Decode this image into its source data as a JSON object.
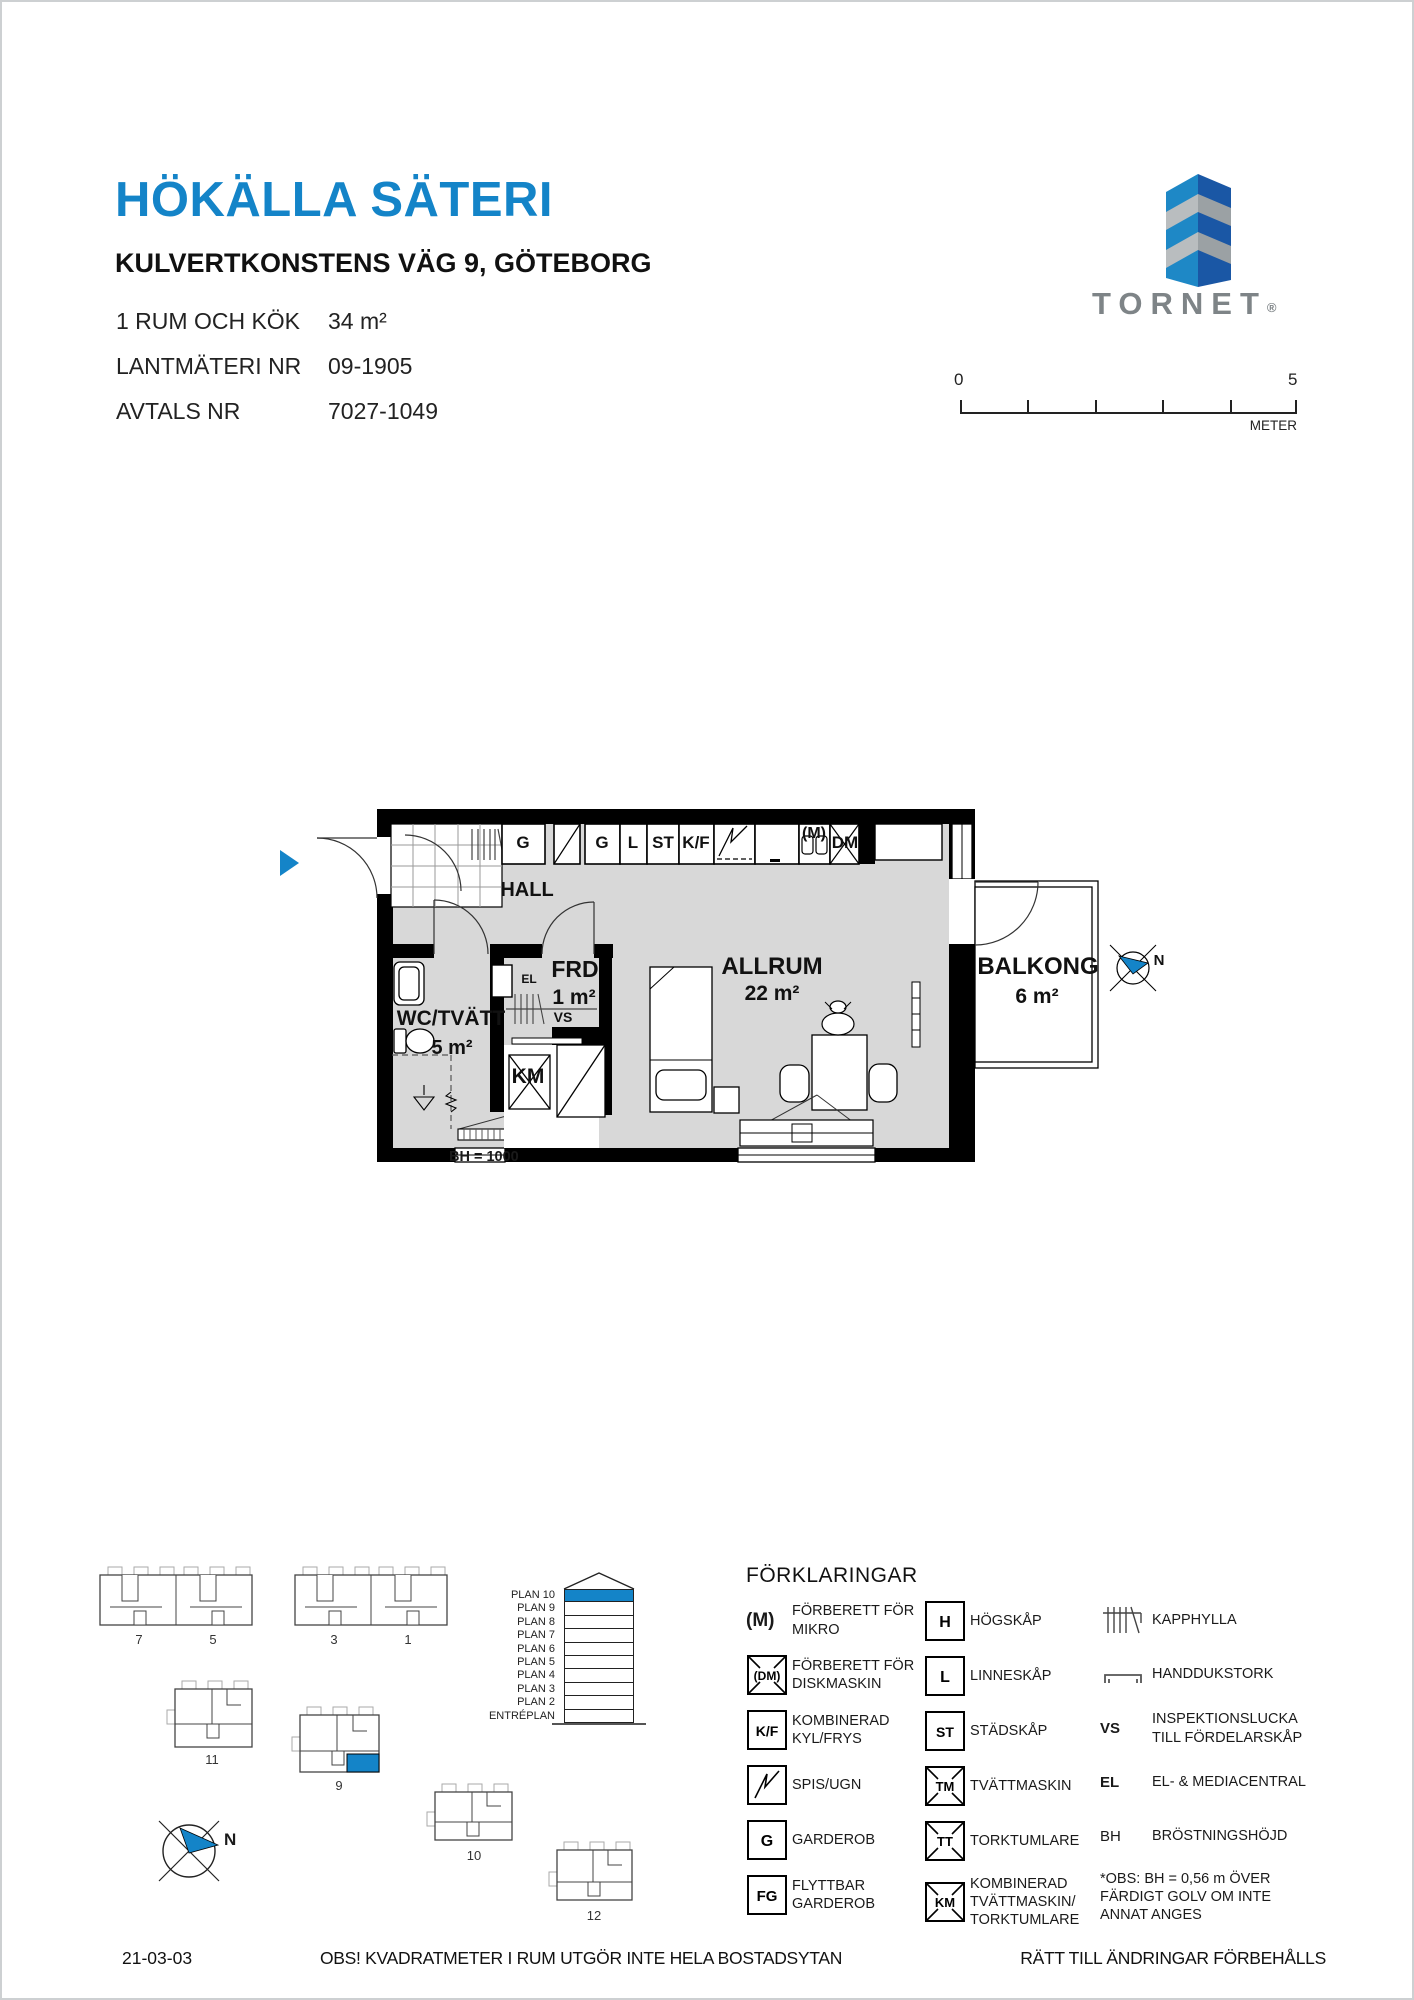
{
  "header": {
    "title": "HÖKÄLLA SÄTERI",
    "address": "KULVERTKONSTENS VÄG 9, GÖTEBORG",
    "info_rows": [
      {
        "label": "1 RUM OCH KÖK",
        "value": "34 m²"
      },
      {
        "label": "LANTMÄTERI NR",
        "value": "09-1905"
      },
      {
        "label": "AVTALS NR",
        "value": "7027-1049"
      }
    ]
  },
  "logo": {
    "brand": "TORNET",
    "registered_mark": "®"
  },
  "scale_bar": {
    "start_label": "0",
    "end_label": "5",
    "unit_label": "METER"
  },
  "floor_plan": {
    "north_label": "N",
    "bh_note": "BH = 1000",
    "cabinets": [
      "G",
      "G",
      "L",
      "ST",
      "K/F",
      "(M)",
      "DM"
    ],
    "rooms": [
      {
        "name": "HALL",
        "area": ""
      },
      {
        "name": "FRD",
        "area": "1 m²"
      },
      {
        "name": "WC/TVÄTT",
        "area": "5 m²"
      },
      {
        "name": "KM",
        "area": ""
      },
      {
        "name": "ALLRUM",
        "area": "22 m²"
      },
      {
        "name": "BALKONG",
        "area": "6 m²"
      }
    ],
    "fixture_labels": {
      "el": "EL",
      "vs": "VS"
    }
  },
  "site_plan": {
    "north_label": "N",
    "building_labels": [
      "7",
      "5",
      "3",
      "1",
      "11",
      "9",
      "10",
      "12"
    ]
  },
  "floor_indicator": {
    "levels": [
      "PLAN 10",
      "PLAN 9",
      "PLAN 8",
      "PLAN 7",
      "PLAN 6",
      "PLAN 5",
      "PLAN 4",
      "PLAN 3",
      "PLAN 2",
      "ENTRÉPLAN"
    ]
  },
  "legend": {
    "title": "FÖRKLARINGAR",
    "col1": [
      {
        "symbol": "(M)",
        "label": "FÖRBERETT FÖR MIKRO"
      },
      {
        "symbol": "(DM)",
        "label": "FÖRBERETT FÖR DISKMASKIN"
      },
      {
        "symbol": "K/F",
        "label": "KOMBINERAD KYL/FRYS"
      },
      {
        "symbol": "",
        "label": "SPIS/UGN"
      },
      {
        "symbol": "G",
        "label": "GARDEROB"
      },
      {
        "symbol": "FG",
        "label": "FLYTTBAR GARDEROB"
      }
    ],
    "col2": [
      {
        "symbol": "H",
        "label": "HÖGSKÅP"
      },
      {
        "symbol": "L",
        "label": "LINNESKÅP"
      },
      {
        "symbol": "ST",
        "label": "STÄDSKÅP"
      },
      {
        "symbol": "TM",
        "label": "TVÄTTMASKIN"
      },
      {
        "symbol": "TT",
        "label": "TORKTUMLARE"
      },
      {
        "symbol": "KM",
        "label": "KOMBINERAD TVÄTTMASKIN/ TORKTUMLARE"
      }
    ],
    "col3": [
      {
        "symbol": "",
        "label": "KAPPHYLLA"
      },
      {
        "symbol": "",
        "label": "HANDDUKSTORK"
      },
      {
        "symbol": "VS",
        "label": "INSPEKTIONSLUCKA TILL FÖRDELARSKÅP"
      },
      {
        "symbol": "EL",
        "label": "EL- & MEDIACENTRAL"
      },
      {
        "symbol": "BH",
        "label": "BRÖSTNINGSHÖJD"
      },
      {
        "symbol": "",
        "label": "*OBS: BH = 0,56 m ÖVER FÄRDIGT GOLV OM INTE ANNAT ANGES"
      }
    ]
  },
  "footer": {
    "date": "21-03-03",
    "note": "OBS! KVADRATMETER I RUM UTGÖR INTE HELA BOSTADSYTAN",
    "rights": "RÄTT TILL ÄNDRINGAR FÖRBEHÅLLS"
  },
  "colors": {
    "accent_blue": "#1484c8",
    "logo_gray": "#7e8487",
    "floor_gray": "#d8d8d8"
  }
}
